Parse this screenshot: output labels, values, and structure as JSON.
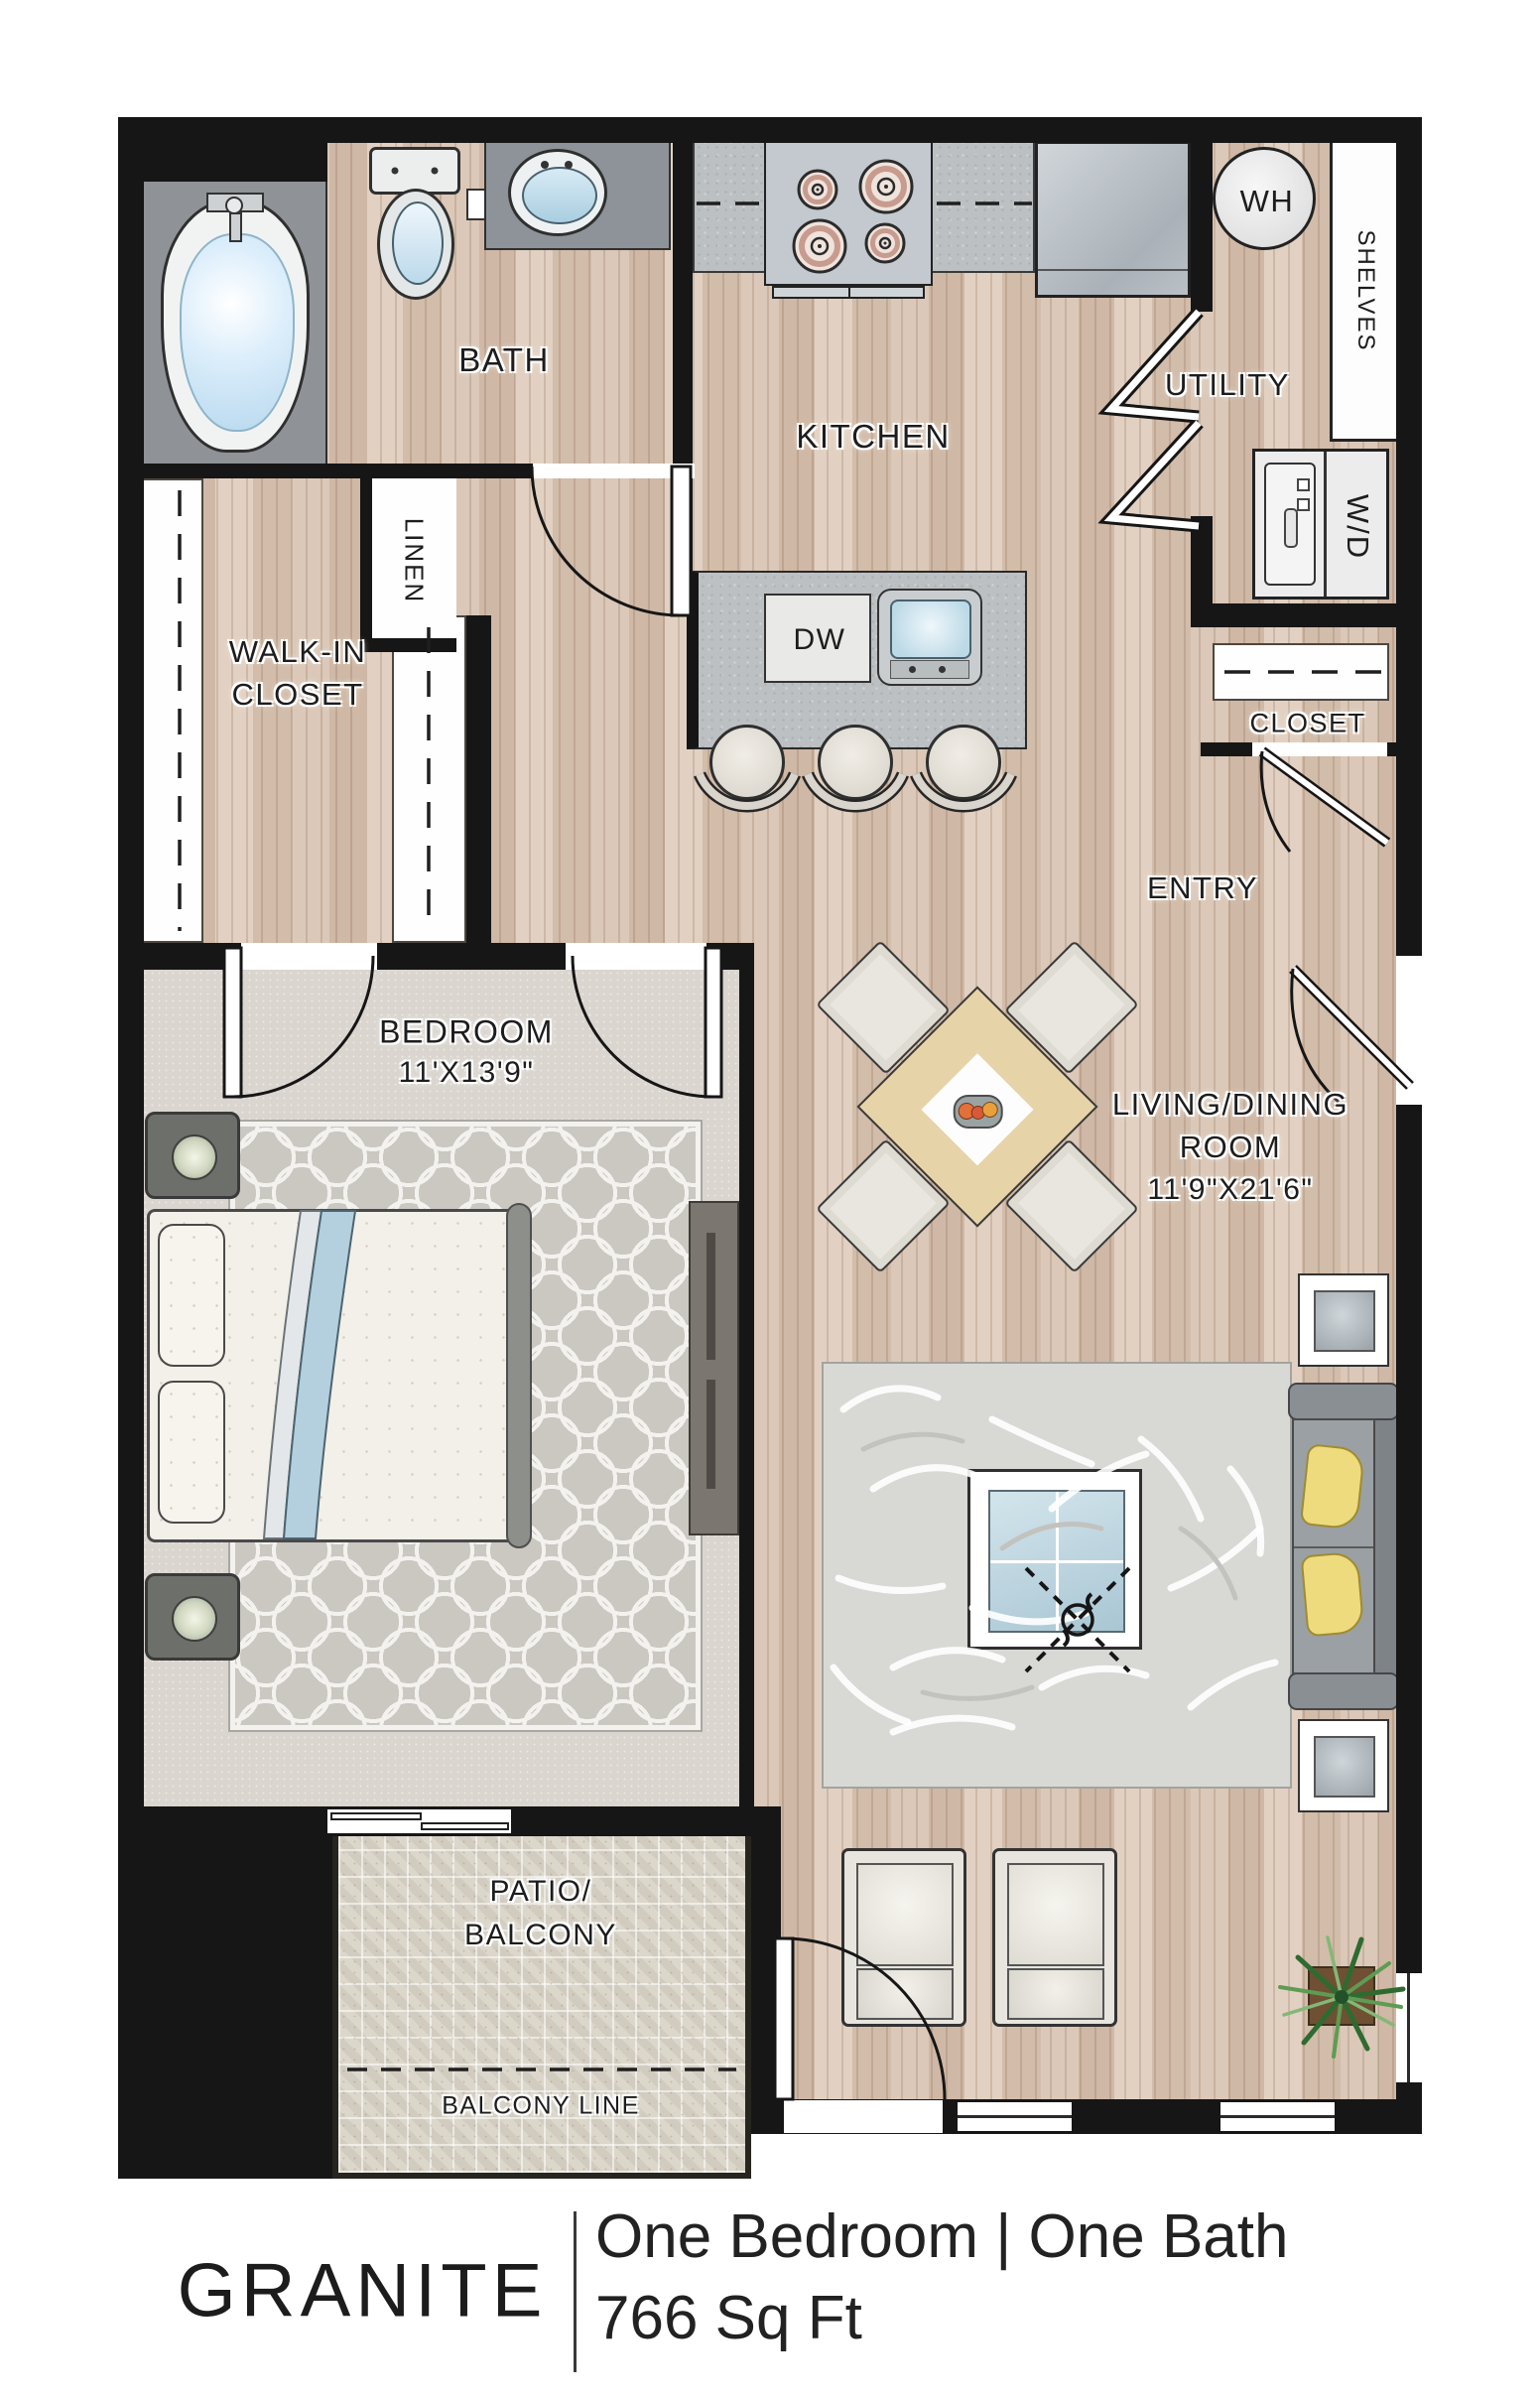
{
  "rooms": {
    "bath": "BATH",
    "kitchen": "KITCHEN",
    "utility": "UTILITY",
    "entry": "ENTRY",
    "linen": "LINEN",
    "walk_in_line1": "WALK-IN",
    "walk_in_line2": "CLOSET",
    "entry_closet": "CLOSET",
    "bedroom_name": "BEDROOM",
    "bedroom_dim": "11'X13'9\"",
    "living_line1": "LIVING/DINING",
    "living_line2": "ROOM",
    "living_dim": "11'9\"X21'6\"",
    "patio_line1": "PATIO/",
    "patio_line2": "BALCONY",
    "balcony_line": "BALCONY LINE"
  },
  "fixtures": {
    "water_heater": "WH",
    "washer_dryer": "W/D",
    "dishwasher": "DW",
    "shelves": "SHELVES"
  },
  "footer": {
    "name": "GRANITE",
    "spec": "One Bedroom | One Bath",
    "area": "766 Sq Ft"
  },
  "colors": {
    "wall": "#161616",
    "wood": "#d5c0af",
    "counter": "#bcc0c2",
    "carpet": "#dad5cf",
    "accent_blue": "#b4d0df",
    "pillow_yellow": "#eddb7e",
    "patio": "#dcd7cb"
  }
}
